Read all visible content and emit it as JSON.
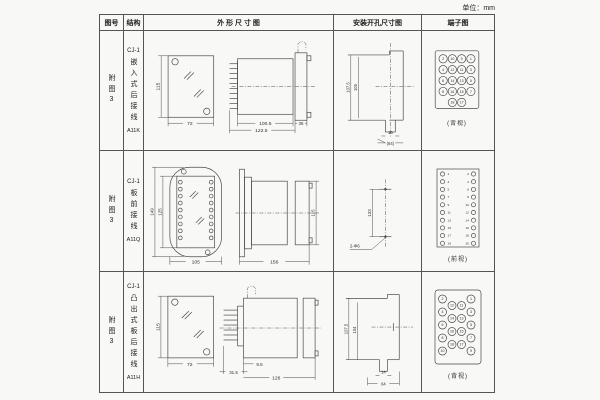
{
  "page": {
    "unit": "单位：mm"
  },
  "headers": {
    "fig_no": "图号",
    "structure": "结构",
    "outline": "外 形 尺 寸 图",
    "install": "安装开孔尺寸图",
    "terminal": "端子图"
  },
  "rows": [
    {
      "fig_no": "附图3",
      "model": "CJ-1",
      "mounting": "嵌入式后接线",
      "code": "A11K",
      "outline": {
        "front_height": "115",
        "front_width": "72",
        "body_len": "100.5",
        "total_len": "122.5",
        "flange_depth": "35"
      },
      "install": {
        "outer_h": "107.5",
        "inner_h": "105",
        "hole_w": "16",
        "span": "(64)"
      },
      "terminal": {
        "view": "(背视)",
        "grid": [
          [
            "2",
            "10",
            "9",
            "1"
          ],
          [
            "4",
            "12",
            "11",
            "3"
          ],
          [
            "6",
            "14",
            "13",
            "5"
          ],
          [
            "8",
            "16",
            "15",
            "7"
          ],
          [
            "18",
            "17"
          ]
        ]
      }
    },
    {
      "fig_no": "附图3",
      "model": "CJ-1",
      "mounting": "板前接线",
      "code": "A11Q",
      "outline": {
        "front_outer_h": "149",
        "front_inner_h": "125",
        "front_width": "105",
        "side_len": "156",
        "side_height": "115"
      },
      "install": {
        "hole_spacing": "133",
        "holes": "2-Φ6"
      },
      "terminal": {
        "view": "(前视)",
        "left": [
          "1",
          "3",
          "5",
          "7",
          "9",
          "11",
          "13",
          "15",
          "17",
          "19"
        ],
        "right": [
          "2",
          "4",
          "6",
          "8",
          "10",
          "12",
          "14",
          "16",
          "18",
          "20"
        ]
      }
    },
    {
      "fig_no": "附图3",
      "model": "CJ-1",
      "mounting": "凸出式板后接线",
      "code": "A11H",
      "outline": {
        "front_height": "115",
        "front_width": "72",
        "pin_len": "31.5",
        "offset": "9.5",
        "body_len": "126"
      },
      "install": {
        "outer_h": "107.5",
        "inner_h": "104",
        "hole_w": "14",
        "span": "64"
      },
      "terminal": {
        "view": "(背视)",
        "cols": [
          [
            "2",
            "4",
            "6",
            "8",
            "10"
          ],
          [
            "12",
            "14",
            "16",
            "18"
          ],
          [
            "11",
            "13",
            "15",
            "17"
          ],
          [
            "1",
            "3",
            "5",
            "7",
            "9"
          ]
        ]
      }
    }
  ]
}
